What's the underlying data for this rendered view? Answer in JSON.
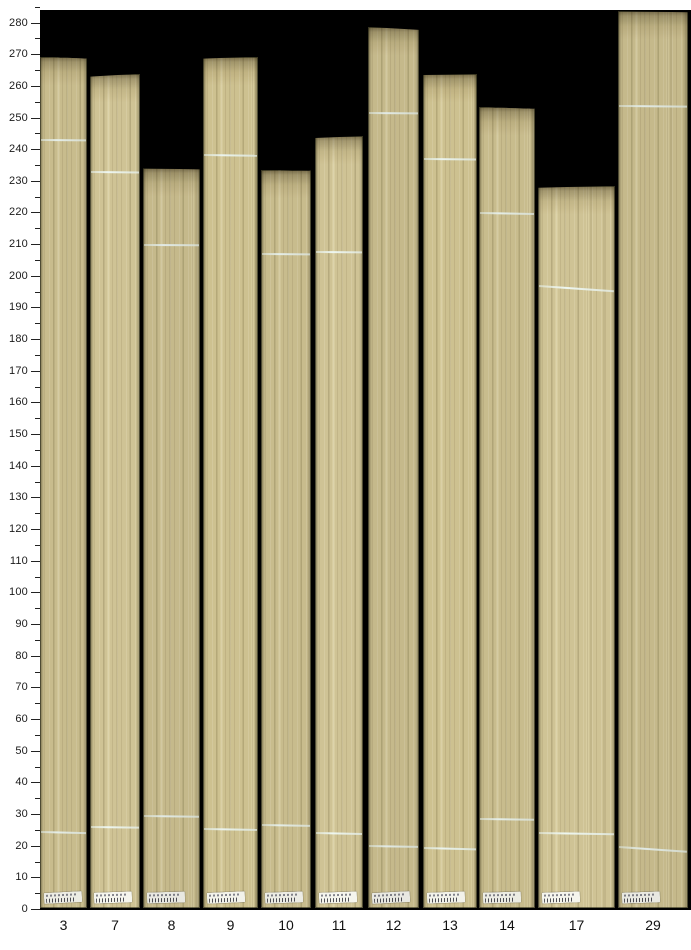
{
  "chart_data": {
    "type": "bar",
    "title": "",
    "xlabel": "",
    "ylabel": "",
    "categories": [
      "3",
      "7",
      "8",
      "9",
      "10",
      "11",
      "12",
      "13",
      "14",
      "17",
      "29"
    ],
    "values": [
      269.4,
      264.0,
      234.1,
      269.4,
      233.6,
      244.3,
      278.8,
      263.9,
      253.5,
      228.6,
      283.7
    ],
    "series": [
      {
        "name": "board-length",
        "values": [
          269.4,
          264.0,
          234.1,
          269.4,
          233.6,
          244.3,
          278.8,
          263.9,
          253.5,
          228.6,
          283.7
        ]
      },
      {
        "name": "upper-chalk-line",
        "values": [
          243.1,
          233.0,
          209.9,
          238.3,
          207.0,
          207.8,
          251.7,
          237.0,
          219.9,
          197.0,
          253.8
        ]
      },
      {
        "name": "lower-chalk-line",
        "values": [
          24.6,
          26.1,
          29.4,
          25.4,
          26.8,
          24.2,
          19.9,
          19.3,
          28.7,
          24.3,
          19.7
        ]
      }
    ],
    "ylim": [
      0,
      285
    ],
    "y_major_step": 10,
    "y_minor_step": 5,
    "y_tick_labels": [
      "0",
      "10",
      "20",
      "30",
      "40",
      "50",
      "60",
      "70",
      "80",
      "90",
      "100",
      "110",
      "120",
      "130",
      "140",
      "150",
      "160",
      "170",
      "180",
      "190",
      "200",
      "210",
      "220",
      "230",
      "240",
      "250",
      "260",
      "270",
      "280"
    ],
    "grid": false,
    "legend_position": "none",
    "bars": [
      {
        "label": "3",
        "x": 40,
        "width": 47,
        "top": 269.4,
        "upper_line": 243.1,
        "lower_line": 24.6,
        "sticker": true
      },
      {
        "label": "7",
        "x": 90,
        "width": 50,
        "top": 264.0,
        "upper_line": 233.0,
        "lower_line": 26.1,
        "sticker": true
      },
      {
        "label": "8",
        "x": 143,
        "width": 57,
        "top": 234.1,
        "upper_line": 209.9,
        "lower_line": 29.4,
        "sticker": true
      },
      {
        "label": "9",
        "x": 203,
        "width": 55,
        "top": 269.4,
        "upper_line": 238.3,
        "lower_line": 25.4,
        "sticker": true
      },
      {
        "label": "10",
        "x": 261,
        "width": 50,
        "top": 233.6,
        "upper_line": 207.0,
        "lower_line": 26.8,
        "sticker": true
      },
      {
        "label": "11",
        "x": 315,
        "width": 48,
        "top": 244.3,
        "upper_line": 207.8,
        "lower_line": 24.2,
        "sticker": true
      },
      {
        "label": "12",
        "x": 368,
        "width": 51,
        "top": 278.8,
        "upper_line": 251.7,
        "lower_line": 19.9,
        "sticker": true
      },
      {
        "label": "13",
        "x": 423,
        "width": 54,
        "top": 263.9,
        "upper_line": 237.0,
        "lower_line": 19.3,
        "sticker": true
      },
      {
        "label": "14",
        "x": 479,
        "width": 56,
        "top": 253.5,
        "upper_line": 219.9,
        "lower_line": 28.7,
        "sticker": true
      },
      {
        "label": "17",
        "x": 538,
        "width": 77,
        "top": 228.6,
        "upper_line": 197.0,
        "lower_line": 24.3,
        "sticker": true
      },
      {
        "label": "29",
        "x": 618,
        "width": 70,
        "top": 283.7,
        "upper_line": 253.8,
        "lower_line": 19.7,
        "sticker": true
      }
    ]
  },
  "colors": {
    "page_background": "#ffffff",
    "plot_background": "#000000",
    "wood_base": "#c8bc8d",
    "wood_light": "#d6cca1",
    "wood_dark": "#a2946a",
    "board_gap": "#1c2112",
    "chalk_line": "#dfe8e3",
    "sticker": "#ecece4",
    "axis_text": "#1a1a1a",
    "tick": "#222222"
  }
}
